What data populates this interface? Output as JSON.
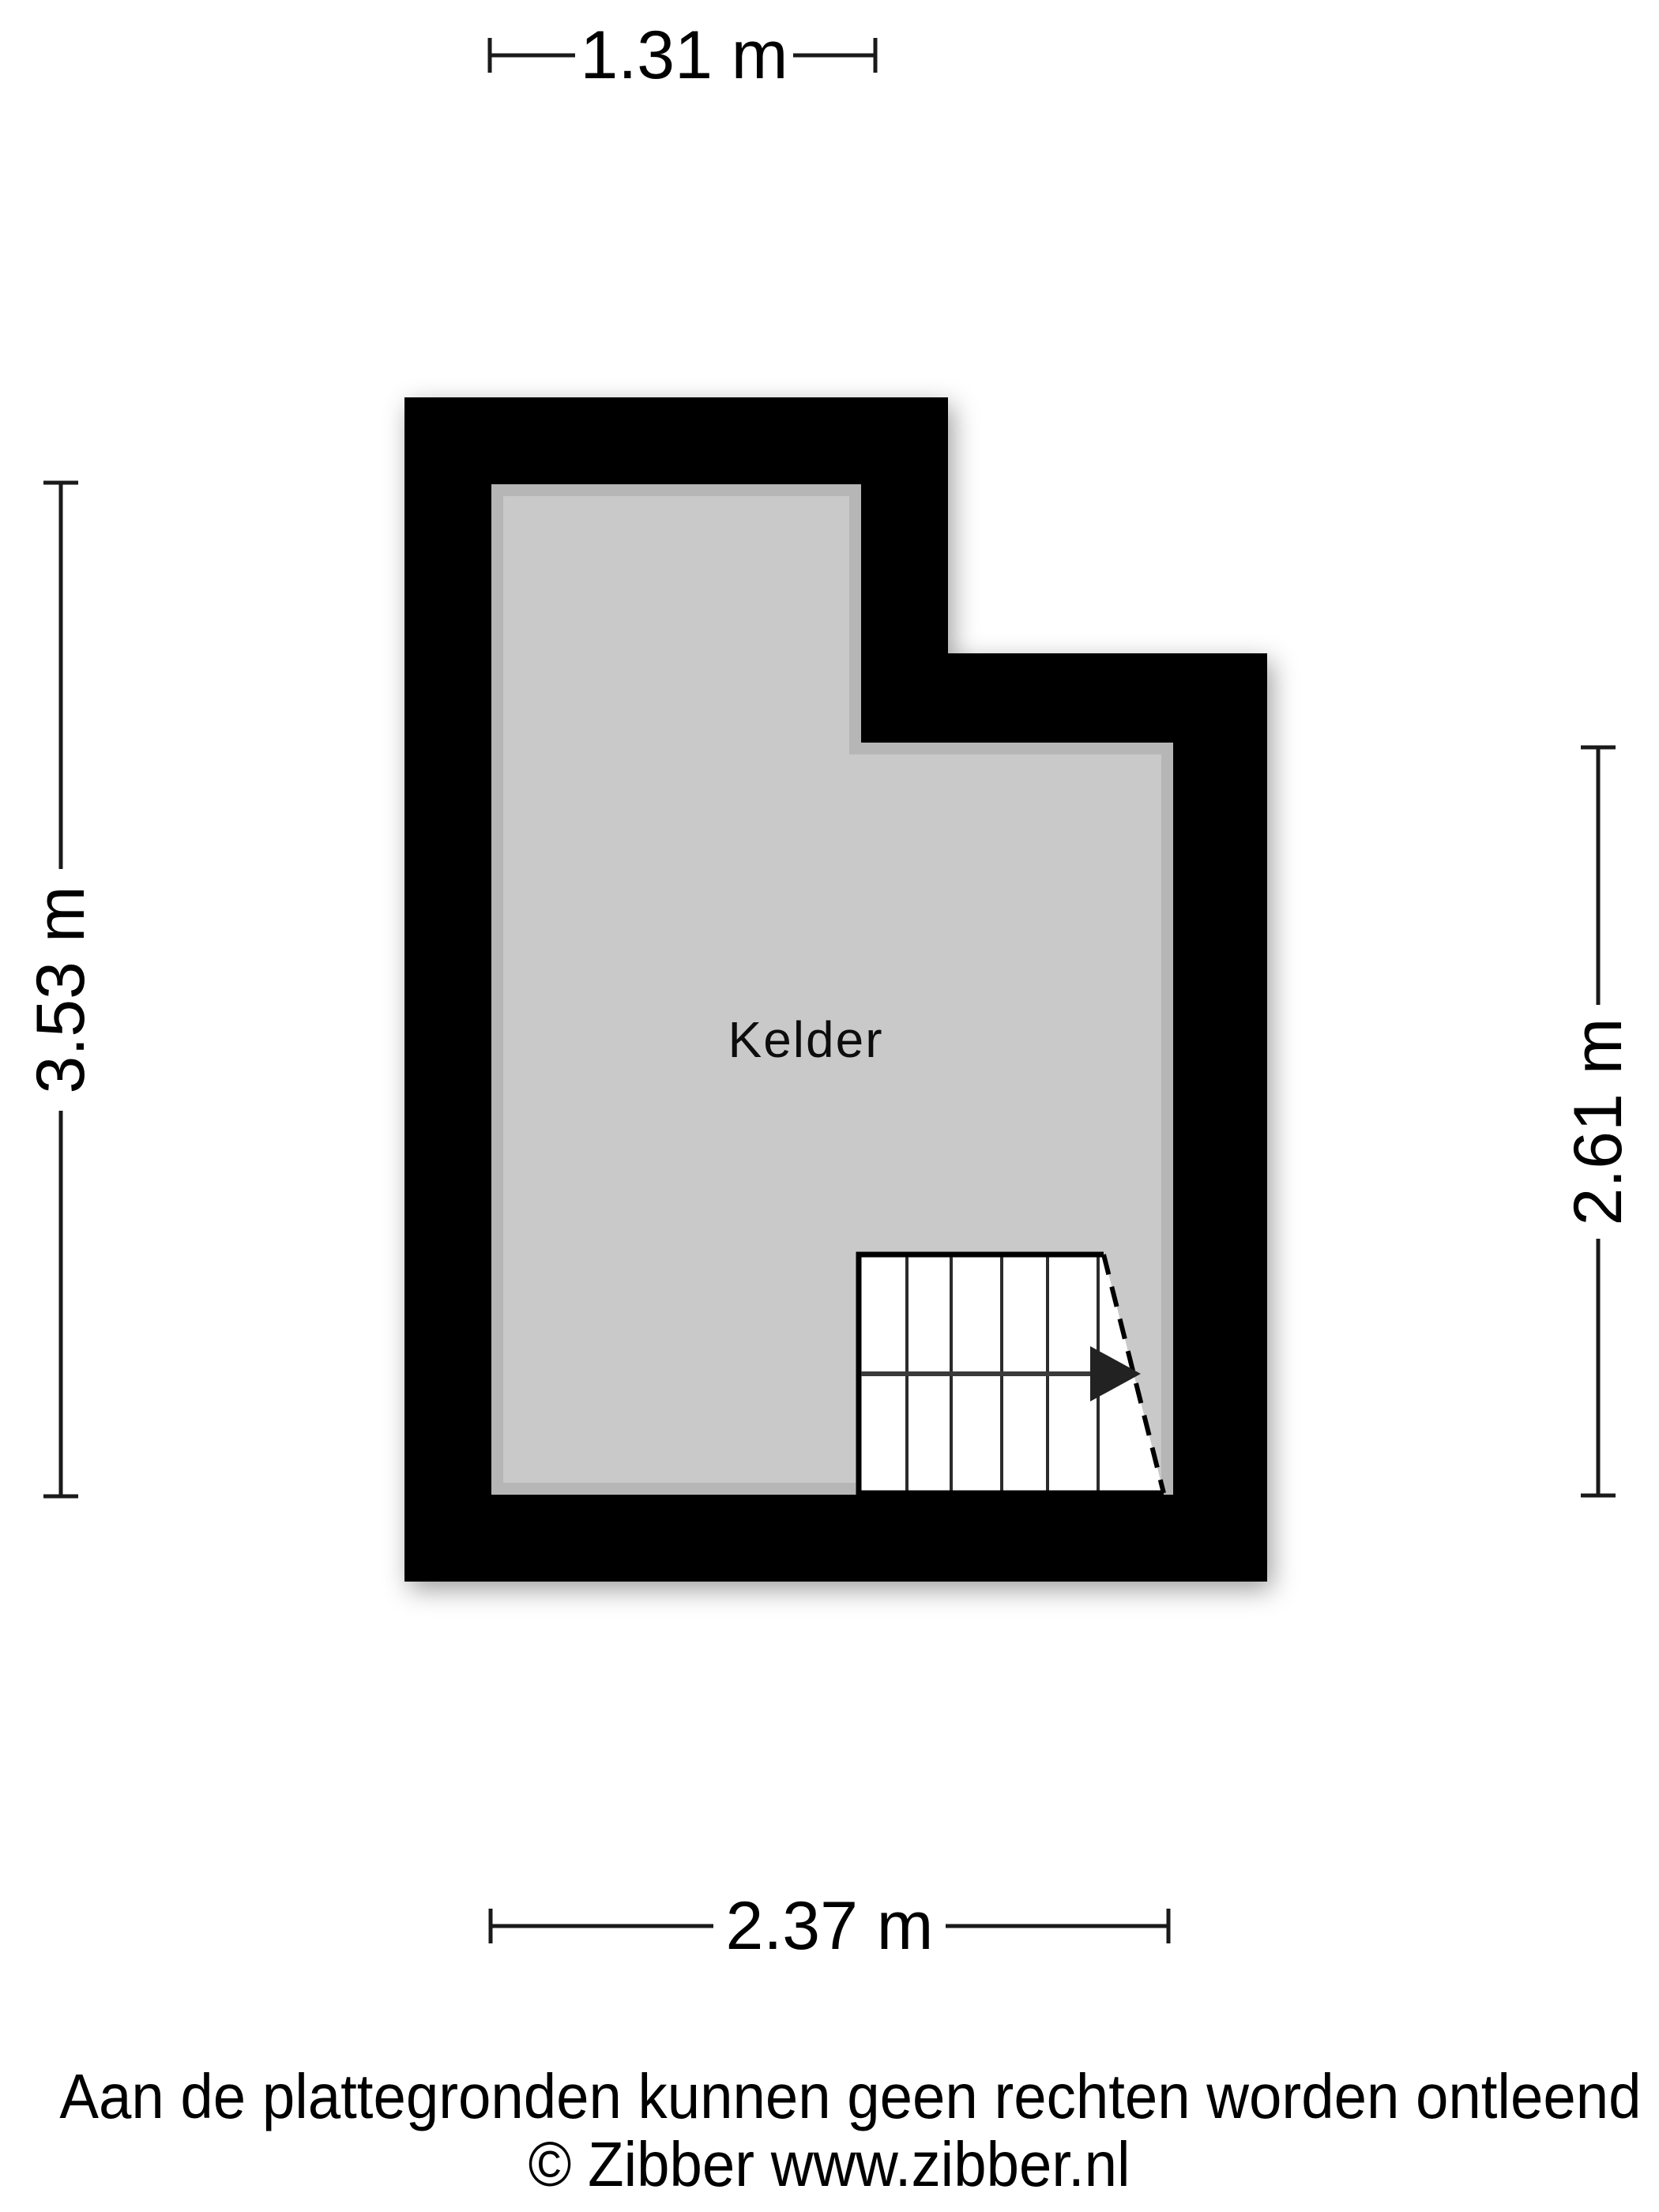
{
  "plan": {
    "room_label": "Kelder",
    "colors": {
      "wall": "#000000",
      "floor": "#c9c9c9",
      "stairs_fill": "#ffffff"
    }
  },
  "dimensions": {
    "top": {
      "label": "1.31 m"
    },
    "left": {
      "label": "3.53 m"
    },
    "right": {
      "label": "2.61 m"
    },
    "bottom": {
      "label": "2.37 m"
    }
  },
  "footer": {
    "disclaimer": "Aan de plattegronden kunnen geen rechten worden ontleend",
    "copyright": "© Zibber www.zibber.nl"
  }
}
